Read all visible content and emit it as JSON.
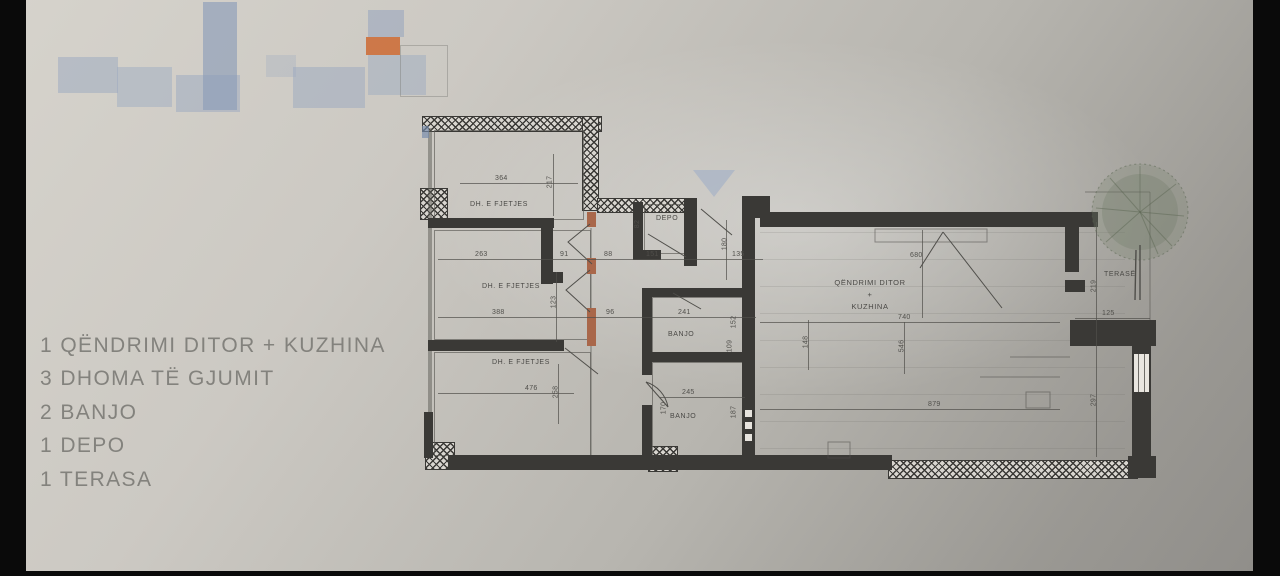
{
  "legend": {
    "items": [
      "1 QËNDRIMI DITOR + KUZHINA",
      "3 DHOMA TË GJUMIT",
      "2 BANJO",
      "1 DEPO",
      "1 TERASA"
    ]
  },
  "plan": {
    "rooms": {
      "bedroom1": "DH. E FJETJES",
      "bedroom2": "DH. E FJETJES",
      "bedroom3": "DH. E FJETJES",
      "depo": "DEPO",
      "bath1": "BANJO",
      "bath2": "BANJO",
      "living_line1": "QËNDRIMI DITOR",
      "living_plus": "+",
      "living_line2": "KUZHINA",
      "terrace": "TERASË"
    },
    "dims": {
      "bedroom1_w": "364",
      "bedroom1_h": "217",
      "row1": [
        "263",
        "91",
        "88",
        "151",
        "135"
      ],
      "depo_h": "82",
      "hall_h": "180",
      "bedroom2_w": "388",
      "hall_w": "96",
      "bedroom2_h": "123",
      "bath1_w": "241",
      "bath1_h1": "152",
      "bath1_h2": "109",
      "bedroom3_w": "476",
      "bedroom3_h": "258",
      "bath2_w": "245",
      "bath2_h1": "170",
      "bath2_h2": "187",
      "living_w_top": "680",
      "living_w_mid": "740",
      "living_h1": "148",
      "living_h2": "546",
      "living_w_bottom": "879",
      "living_h_right": "297",
      "terrace_h": "219",
      "terrace_w": "125"
    }
  },
  "colors": {
    "accent_orange": "#cc6a33",
    "site_blue": "#9aa8c0",
    "wall": "#3a3936",
    "door_jamb": "#a9674a",
    "entry_arrow_blue": "#94a8c6",
    "tree_green": "#7a8670"
  }
}
